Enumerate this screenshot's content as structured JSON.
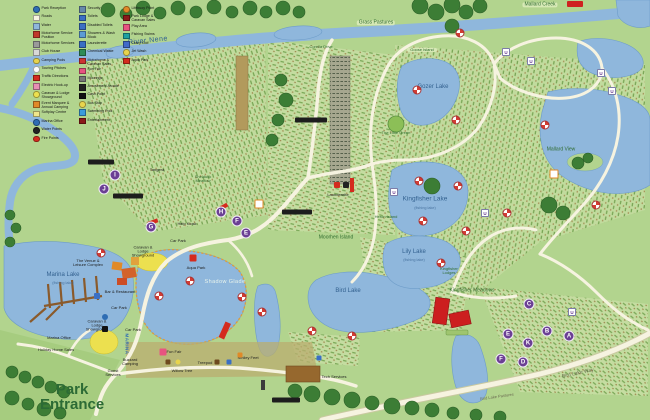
{
  "river": {
    "name": "River Nene"
  },
  "park_entrance": {
    "line1": "Park",
    "line2": "Entrance"
  },
  "lakes": {
    "gozer": {
      "name": "Gozer Lake"
    },
    "kingfisher": {
      "name": "Kingfisher Lake",
      "sub": "(fishing lake)"
    },
    "lily": {
      "name": "Lily Lake",
      "sub": "(fishing lake)"
    },
    "bird": {
      "name": "Bird Lake"
    },
    "marina": {
      "name": "Marina Lake",
      "sub": "(fishing lake)"
    },
    "shadow": {
      "name": "Shadow Glade"
    }
  },
  "areas": {
    "grass_pastures": "Grass Pastures",
    "mallard_creek": "Mallard Creek",
    "corella_drive": "Corella Drive",
    "goose_island": "Goose Island",
    "little_green": "The Little Green",
    "mallard_view": "Mallard View",
    "heron_island": "Heron Island",
    "moorhen_island": "Moorhen Island",
    "kingfisher_lodges": "Kingfisher Lodges",
    "kingfisher_meadows": "Kingfisher Meadows",
    "shelduck_meadow": "Shelduck Meadow",
    "tangera": "Tangera",
    "bird_lake_way": "Bird Lake Way",
    "bird_lake_pastures": "Bird Lake Pastures"
  },
  "facilities": {
    "venue": "The Venue & Leisure Complex",
    "bar": "Bar & Restaurant",
    "car_park": "Car Park",
    "showground": "Caravan & Lodge Showground",
    "marina_office": "Marina Office",
    "holiday_home_sales": "Holiday Home Sales",
    "marina": "MARINA",
    "buzzard_camping": "Buzzard Camping",
    "guest_services": "Guest Services",
    "launderette": "Launderette",
    "aqua_park": "Aqua Park",
    "fun_fair": "Fun Fair",
    "treepod": "Treepod",
    "smiley_feet": "Smiley Feet",
    "willow_tree": "Willow Tree",
    "tech_services": "Tech Services",
    "help_kiosk": "Help Kiosk"
  },
  "markers": {
    "a": "A",
    "b": "B",
    "c": "C",
    "d": "D",
    "e": "E",
    "f": "F",
    "g": "G",
    "h": "H",
    "i": "I",
    "j": "J",
    "k": "K",
    "e2": "E",
    "f2": "F",
    "u": "U"
  },
  "legend": {
    "col1": [
      {
        "icon": "reception-icon",
        "shape": "circle",
        "color": "#2e6db4",
        "label": "Park Reception"
      },
      {
        "icon": "roads-icon",
        "shape": "square",
        "color": "#f7f4e2",
        "label": "Roads"
      },
      {
        "icon": "water-icon",
        "shape": "square",
        "color": "#8fb7dc",
        "label": "Water"
      },
      {
        "icon": "motorhome-service-icon",
        "shape": "square",
        "color": "#c0392b",
        "label": "Motorhome Service Position"
      },
      {
        "icon": "motorhome-services-icon",
        "shape": "square",
        "color": "#9a9a9a",
        "label": "Motorhome Services"
      },
      {
        "icon": "club-house-icon",
        "shape": "square",
        "color": "#d8d8d8",
        "label": "Club House"
      },
      {
        "icon": "camping-pods-icon",
        "shape": "circle",
        "color": "#e8d44d",
        "label": "Camping Pods"
      },
      {
        "icon": "touring-pitches-icon",
        "shape": "circle",
        "color": "#ffffff",
        "label": "Touring Pitches"
      },
      {
        "icon": "traffic-direction-icon",
        "shape": "square",
        "color": "#d42b1e",
        "label": "Traffic Directions"
      },
      {
        "icon": "hookup-icon",
        "shape": "square",
        "color": "#e78fb3",
        "label": "Electric Hook-up"
      },
      {
        "icon": "showground-icon",
        "shape": "circle",
        "color": "#ece04f",
        "label": "Caravan & Lodge Showground"
      },
      {
        "icon": "events-icon",
        "shape": "square",
        "color": "#e08a28",
        "label": "Event Marquee & Annual Camping"
      },
      {
        "icon": "softplay-icon",
        "shape": "square",
        "color": "#f0e68c",
        "label": "Softplay Centre"
      },
      {
        "icon": "marina-office-icon",
        "shape": "circle",
        "color": "#2e6db4",
        "label": "Marina Office"
      },
      {
        "icon": "water-point-icon",
        "shape": "circle",
        "color": "#222222",
        "label": "Water Points"
      },
      {
        "icon": "fire-point-icon",
        "shape": "circle",
        "color": "#d42b1e",
        "label": "Fire Points"
      }
    ],
    "col2": [
      {
        "icon": "security-icon",
        "shape": "square",
        "color": "#6688aa",
        "label": "Security"
      },
      {
        "icon": "toilets-icon",
        "shape": "square",
        "color": "#3a6fc4",
        "label": "Toilets"
      },
      {
        "icon": "disabled-toilets-icon",
        "shape": "square",
        "color": "#3a6fc4",
        "label": "Disabled Toilets"
      },
      {
        "icon": "showers-icon",
        "shape": "square",
        "color": "#5b9bd5",
        "label": "Showers & Wash Block"
      },
      {
        "icon": "launderette-icon",
        "shape": "square",
        "color": "#3a6fc4",
        "label": "Launderette"
      },
      {
        "icon": "chemical-waste-icon",
        "shape": "square",
        "color": "#2e8b57",
        "label": "Chemical Waste"
      },
      {
        "icon": "motorhome-sales-icon",
        "shape": "square",
        "color": "#cc3333",
        "label": "Motorhome & Caravan Sales"
      },
      {
        "icon": "fun-fair-icon",
        "shape": "square",
        "color": "#e75480",
        "label": "Fun Fair"
      },
      {
        "icon": "moorings-icon",
        "shape": "square",
        "color": "#777777",
        "label": "Moorings"
      },
      {
        "icon": "arcade-icon",
        "shape": "square",
        "color": "#222222",
        "label": "Amusement Arcade"
      },
      {
        "icon": "cash-point-icon",
        "shape": "square",
        "color": "#111111",
        "label": "Cash Point"
      },
      {
        "icon": "bus-stop-icon",
        "shape": "circle",
        "color": "#e8d44d",
        "label": "Bus Stop"
      },
      {
        "icon": "swimming-pool-icon",
        "shape": "square",
        "color": "#3a9bdc",
        "label": "Swimming Pool"
      },
      {
        "icon": "entertainment-icon",
        "shape": "square",
        "color": "#8b1a1a",
        "label": "Entertainment"
      }
    ],
    "col3": [
      {
        "icon": "lifebuoy-icon",
        "shape": "circle",
        "color": "#e08a28",
        "label": "Lifebuoy Point"
      },
      {
        "icon": "lodge-sales-icon",
        "shape": "square",
        "color": "#8b1a1a",
        "label": "Park Lodge & Caravan Sales"
      },
      {
        "icon": "play-area-icon",
        "shape": "square",
        "color": "#e75480",
        "label": "Play Area"
      },
      {
        "icon": "fishing-icon",
        "shape": "square",
        "color": "#20a0a0",
        "label": "Fishing Swims"
      },
      {
        "icon": "crazy-golf-icon",
        "shape": "square",
        "color": "#4169c8",
        "label": "Crazy Golf"
      },
      {
        "icon": "jet-wash-icon",
        "shape": "circle",
        "color": "#e8d44d",
        "label": "Jet Wash"
      },
      {
        "icon": "aqua-park-icon",
        "shape": "square",
        "color": "#d42b1e",
        "label": "Aqua Park"
      }
    ]
  }
}
